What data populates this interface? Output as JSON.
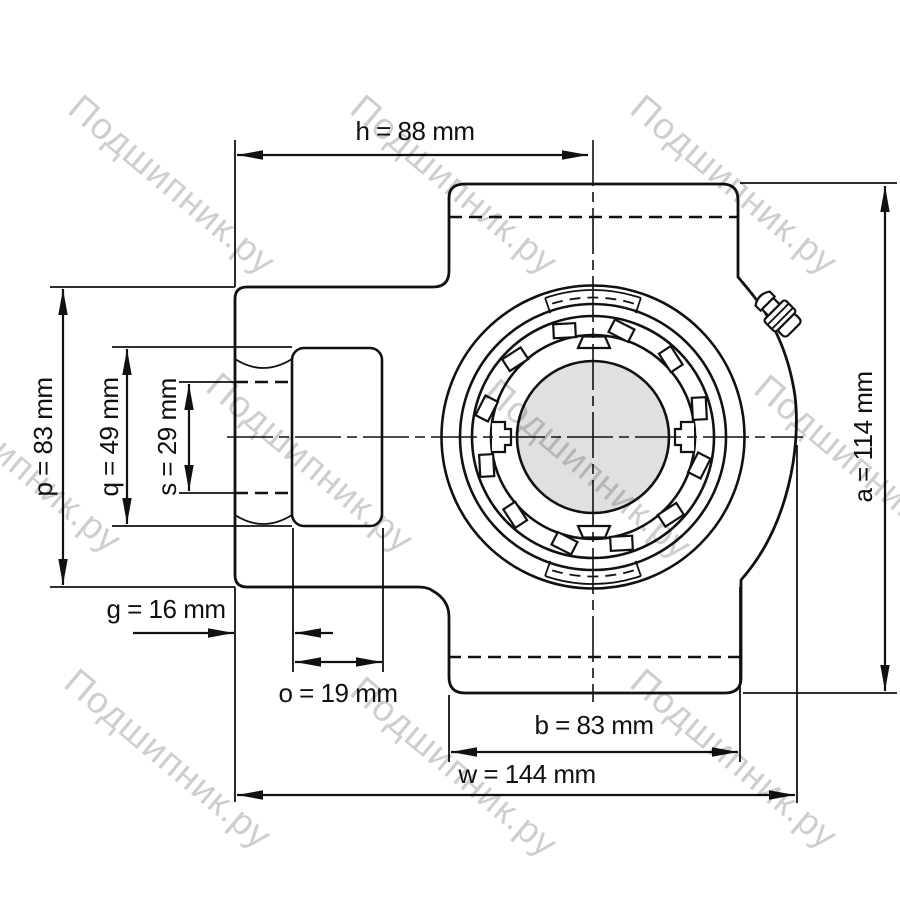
{
  "title": "Take-up bearing unit — dimensional drawing",
  "watermark": {
    "text": "Подшипник.ру",
    "color_hex": "#c4c4c4"
  },
  "colors": {
    "line": "#111111",
    "shaft_fill": "#e0e0e0",
    "background": "#ffffff"
  },
  "units": "mm",
  "dimensions": {
    "h": {
      "name": "h",
      "value_mm": 88,
      "label": "h = 88 mm"
    },
    "p": {
      "name": "p",
      "value_mm": 83,
      "label": "p = 83 mm"
    },
    "q": {
      "name": "q",
      "value_mm": 49,
      "label": "q = 49 mm"
    },
    "s": {
      "name": "s",
      "value_mm": 29,
      "label": "s = 29 mm"
    },
    "g": {
      "name": "g",
      "value_mm": 16,
      "label": "g = 16 mm"
    },
    "o": {
      "name": "o",
      "value_mm": 19,
      "label": "o = 19 mm"
    },
    "b": {
      "name": "b",
      "value_mm": 83,
      "label": "b = 83 mm"
    },
    "w": {
      "name": "w",
      "value_mm": 144,
      "label": "w = 144 mm"
    },
    "a": {
      "name": "a",
      "value_mm": 114,
      "label": "a = 114 mm"
    }
  }
}
